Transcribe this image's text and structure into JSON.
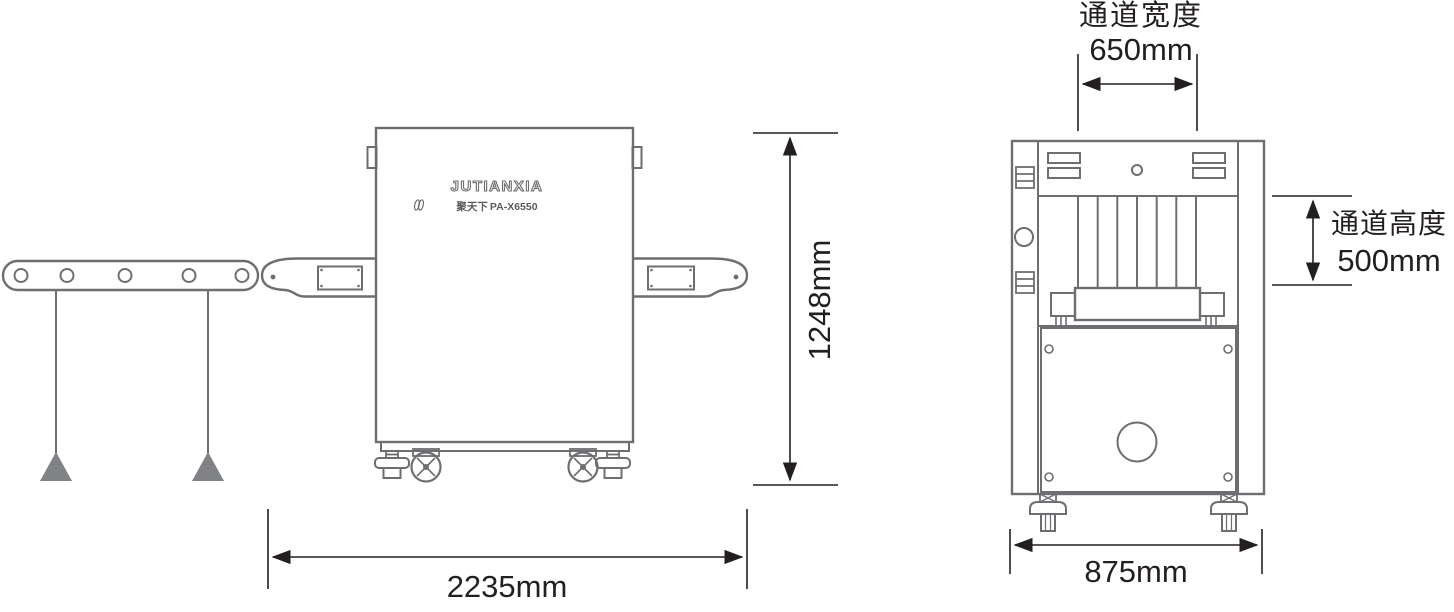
{
  "machine": {
    "brand": "JUTIANXIA",
    "brand_cn": "聚天下",
    "model": "PA-X6550"
  },
  "dimensions": {
    "tunnel_width": {
      "label": "通道宽度",
      "value": "650mm"
    },
    "tunnel_height": {
      "label": "通道高度",
      "value": "500mm"
    },
    "overall_length": "2235mm",
    "overall_height": "1248mm",
    "overall_width": "875mm"
  },
  "colors": {
    "outline": "#6d6e71",
    "fill_solid": "#808285",
    "dimension_lines": "#231f20",
    "background": "#ffffff"
  },
  "views": {
    "left": "side-view-xray-baggage-scanner-with-roller-table",
    "right": "front-view-tunnel-opening-with-lead-curtains"
  }
}
